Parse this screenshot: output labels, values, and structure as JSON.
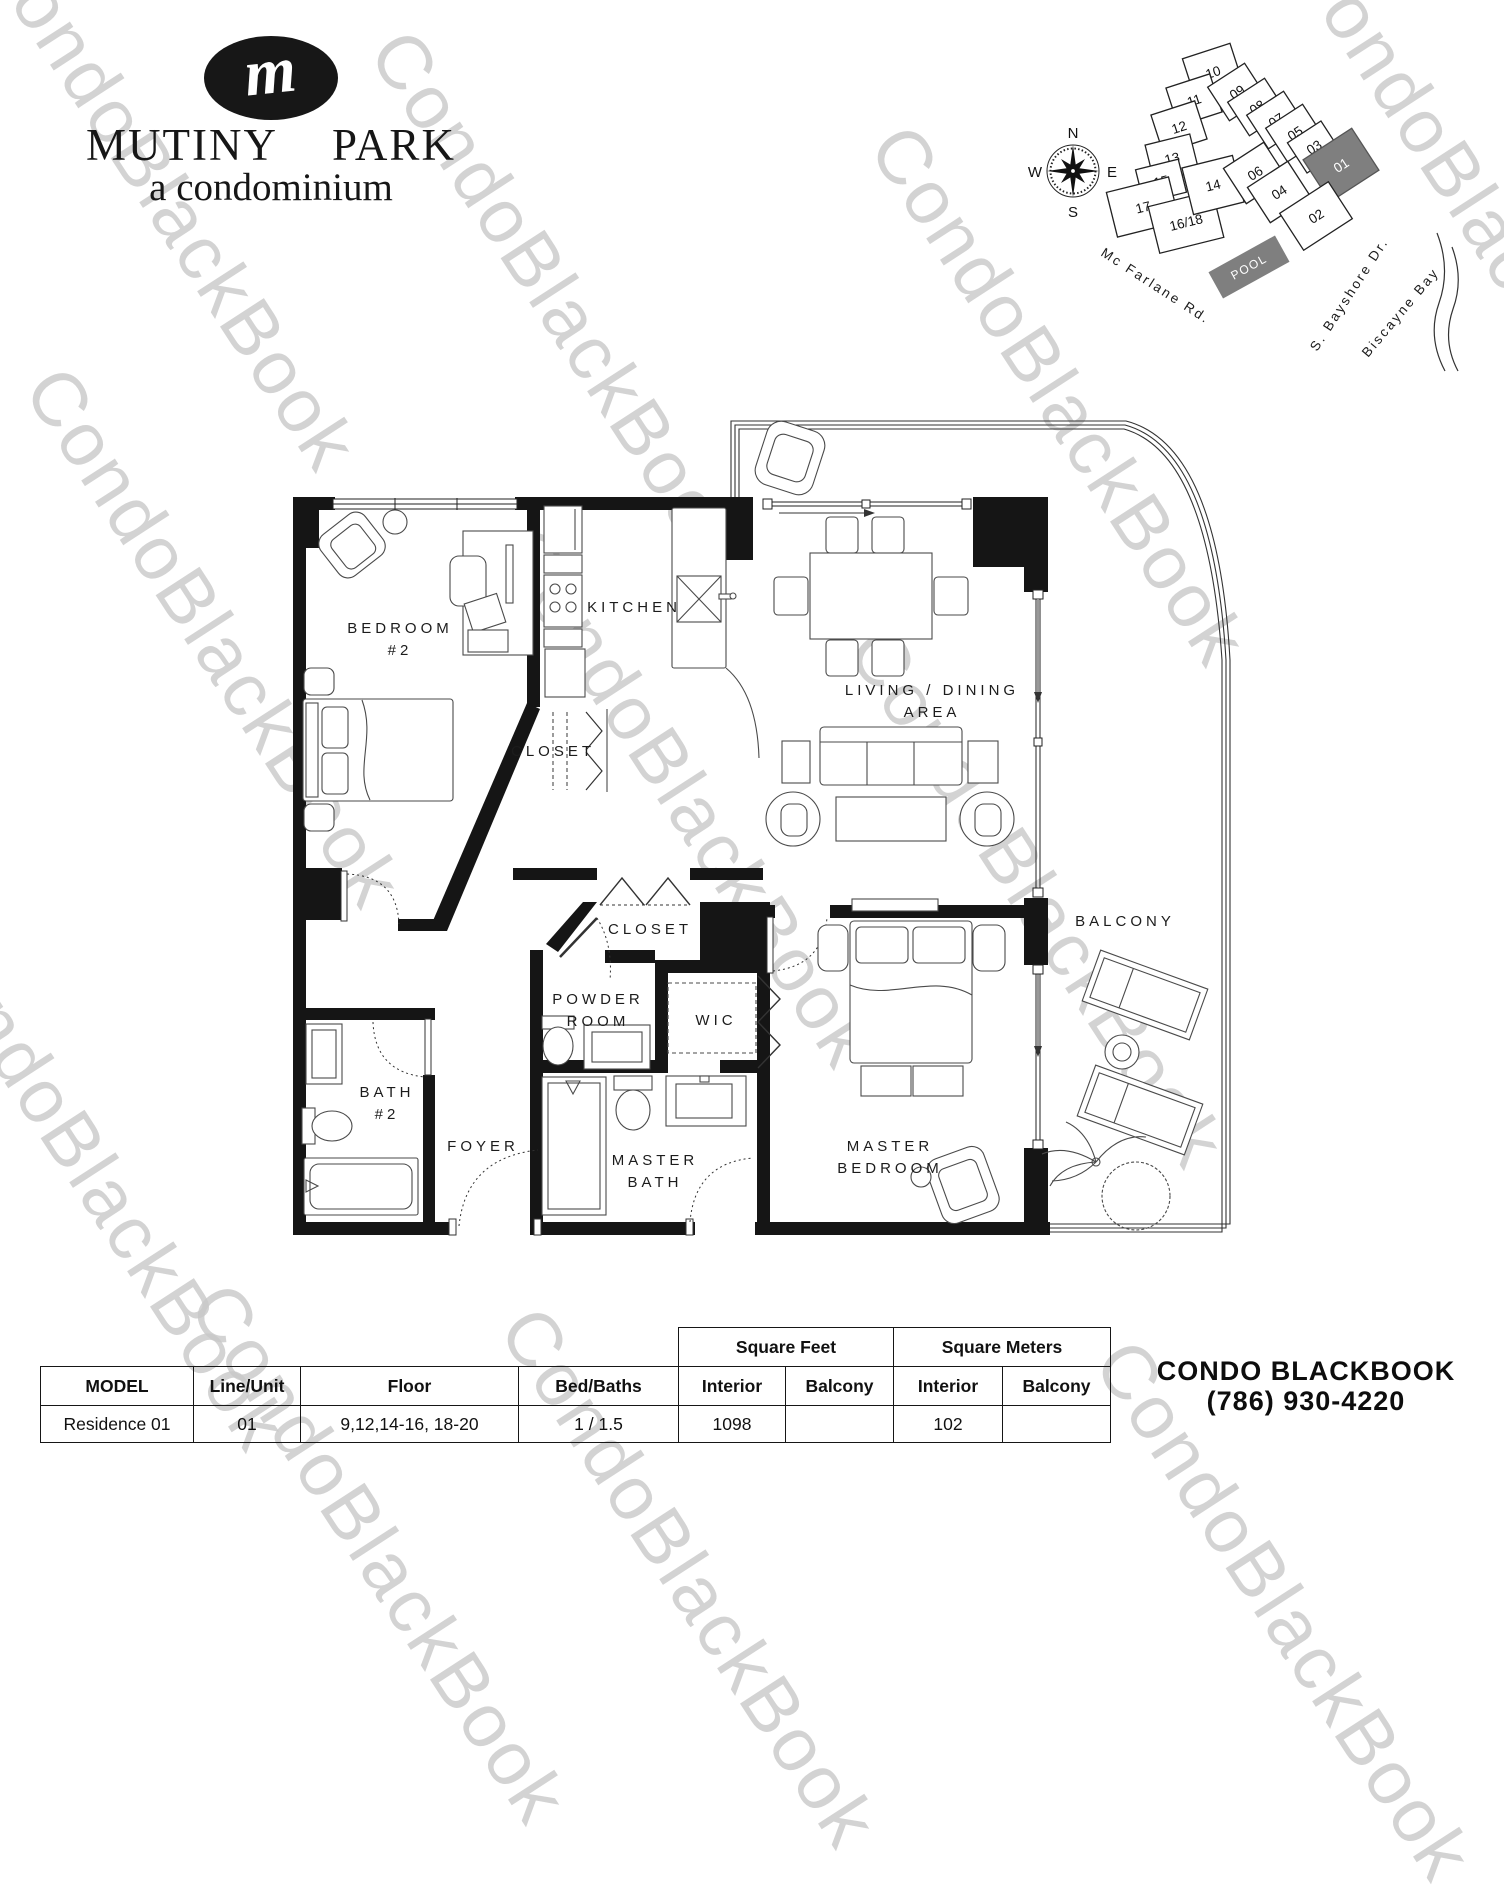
{
  "page": {
    "background": "#ffffff"
  },
  "watermark": {
    "text": "CondoBlackBook",
    "color": "#c9c9c9"
  },
  "logo": {
    "monogram": "m",
    "word1": "MUTINY",
    "word2": "PARK",
    "tagline": "a condominium"
  },
  "keyplan": {
    "compass": {
      "n": "N",
      "e": "E",
      "s": "S",
      "w": "W"
    },
    "units": [
      {
        "label": "10"
      },
      {
        "label": "11"
      },
      {
        "label": "12"
      },
      {
        "label": "13"
      },
      {
        "label": "15"
      },
      {
        "label": "17"
      },
      {
        "label": "16/18"
      },
      {
        "label": "14"
      },
      {
        "label": "09"
      },
      {
        "label": "08"
      },
      {
        "label": "07"
      },
      {
        "label": "05"
      },
      {
        "label": "03"
      },
      {
        "label": "01"
      },
      {
        "label": "06"
      },
      {
        "label": "04"
      },
      {
        "label": "02"
      }
    ],
    "highlighted_unit": "01",
    "highlight_color": "#7f7f7f",
    "pool": "POOL",
    "streets": {
      "mcfarlane": "Mc Farlane Rd.",
      "bayshore": "S. Bayshore Dr.",
      "biscayne": "Biscayne Bay"
    }
  },
  "floorplan": {
    "labels": {
      "bedroom2_1": "BEDROOM",
      "bedroom2_2": "#2",
      "kitchen": "KITCHEN",
      "closet_upper": "CLOSET",
      "living_1": "LIVING / DINING",
      "living_2": "AREA",
      "closet_lower": "CLOSET",
      "powder_1": "POWDER",
      "powder_2": "ROOM",
      "wic": "WIC",
      "bath2_1": "BATH",
      "bath2_2": "#2",
      "foyer": "FOYER",
      "master_bath_1": "MASTER",
      "master_bath_2": "BATH",
      "master_bed_1": "MASTER",
      "master_bed_2": "BEDROOM",
      "balcony": "BALCONY"
    }
  },
  "table": {
    "group": {
      "sqft": "Square Feet",
      "sqm": "Square Meters"
    },
    "headers": {
      "model": "MODEL",
      "line_unit": "Line/Unit",
      "floor": "Floor",
      "bed_baths": "Bed/Baths",
      "interior": "Interior",
      "balcony": "Balcony"
    },
    "row": {
      "model": "Residence 01",
      "line_unit": "01",
      "floor": "9,12,14-16, 18-20",
      "bed_baths": "1 / 1.5",
      "sqft_interior": "1098",
      "sqft_balcony": "",
      "sqm_interior": "102",
      "sqm_balcony": ""
    }
  },
  "footer": {
    "brand_a": "CONDO",
    "brand_b": "BLACKBOOK",
    "phone": "(786) 930-4220"
  }
}
